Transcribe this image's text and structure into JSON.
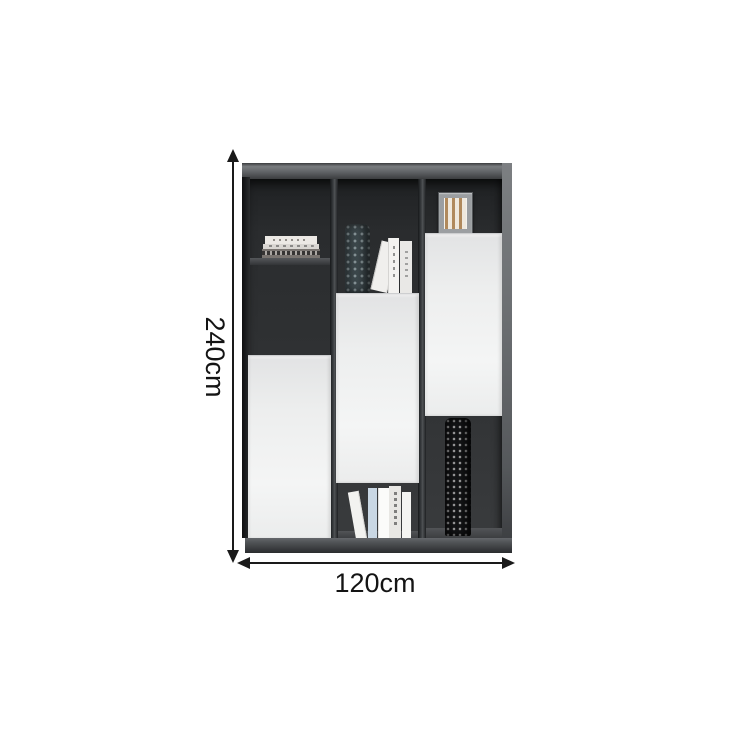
{
  "page": {
    "background": "#ffffff",
    "description": "Product dimension diagram of a two-tone bookshelf cabinet"
  },
  "annotations": {
    "height_label": "240cm",
    "width_label": "120cm",
    "line_color": "#1a1a1a"
  },
  "cabinet": {
    "type": "bookshelf-cabinet",
    "colors": {
      "interior": "#2e3032",
      "top_face": "#6b6e71",
      "side_face": "#6b6e71",
      "divider": "#3f4245",
      "door": "#eff0f1",
      "plinth": "#45484b",
      "teal_vase": "#3d484c",
      "black_vase": "#141517",
      "picture_frame": "#9b9ea1",
      "book_blue": "#c9d7e4",
      "book_white": "#f3f2f0"
    },
    "columns": [
      {
        "name": "left",
        "items": [
          "stacked-horizontal-books",
          "open-shelf",
          "open-compartment",
          "white-door-lower"
        ]
      },
      {
        "name": "middle",
        "items": [
          "teal-pattern-vase",
          "leaning-book",
          "upright-books",
          "white-door-middle",
          "bottom-shelf-books"
        ]
      },
      {
        "name": "right",
        "items": [
          "picture-frame",
          "white-door-upper",
          "black-pattern-vase",
          "open-bottom-compartment"
        ]
      }
    ]
  }
}
